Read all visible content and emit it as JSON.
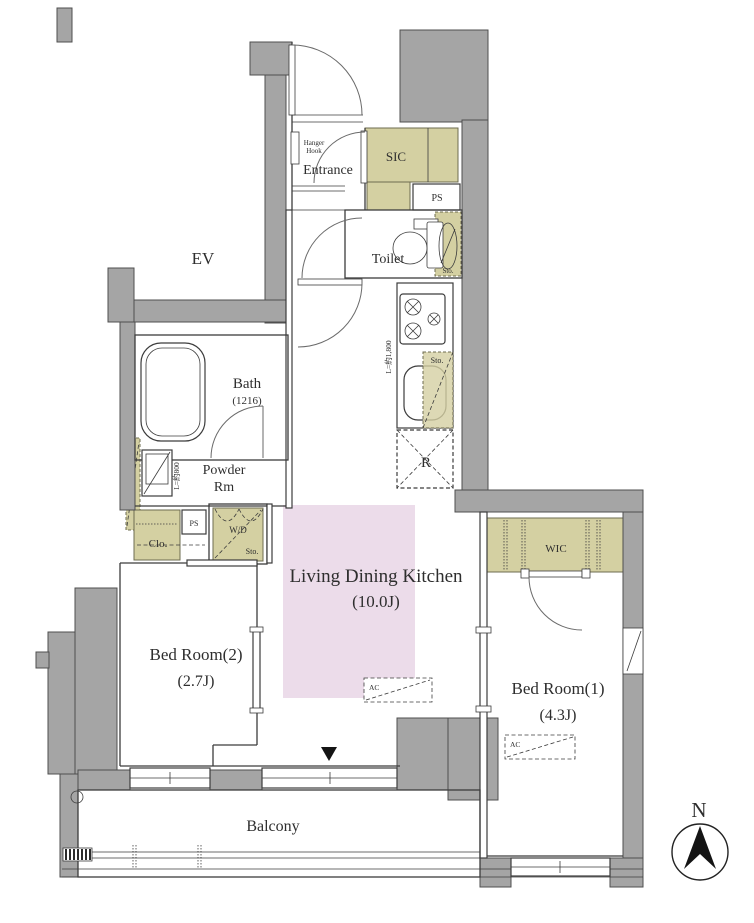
{
  "colors": {
    "wall_gray": "#a5a5a5",
    "storage_olive": "#d4d0a2",
    "ldk_pink": "#ecdcea",
    "line": "#3c3c3c"
  },
  "labels": {
    "ev": "EV",
    "hanger_hook": [
      "Hanger",
      "Hook"
    ],
    "entrance": "Entrance",
    "sic": "SIC",
    "ps_upper": "PS",
    "toilet": "Toilet",
    "toilet_storage": "Sto.",
    "bath": "Bath",
    "bath_size": "(1216)",
    "powder": [
      "Powder",
      "Rm"
    ],
    "powder_counter_length": "L=約800",
    "kitchen_counter_length": "L=約1,800",
    "kitchen_storage": "Sto.",
    "refrigerator": "R",
    "closet": "Clo.",
    "ps_lower": "PS",
    "washer_dryer": "W/D",
    "washer_storage": "Sto.",
    "ldk": "Living Dining Kitchen",
    "ldk_size": "(10.0J)",
    "ldk_ac": "AC",
    "bedroom2": "Bed Room(2)",
    "bedroom2_size": "(2.7J)",
    "bedroom1": "Bed Room(1)",
    "bedroom1_size": "(4.3J)",
    "bedroom1_ac": "AC",
    "wic": "WIC",
    "balcony": "Balcony",
    "compass_north": "N"
  }
}
